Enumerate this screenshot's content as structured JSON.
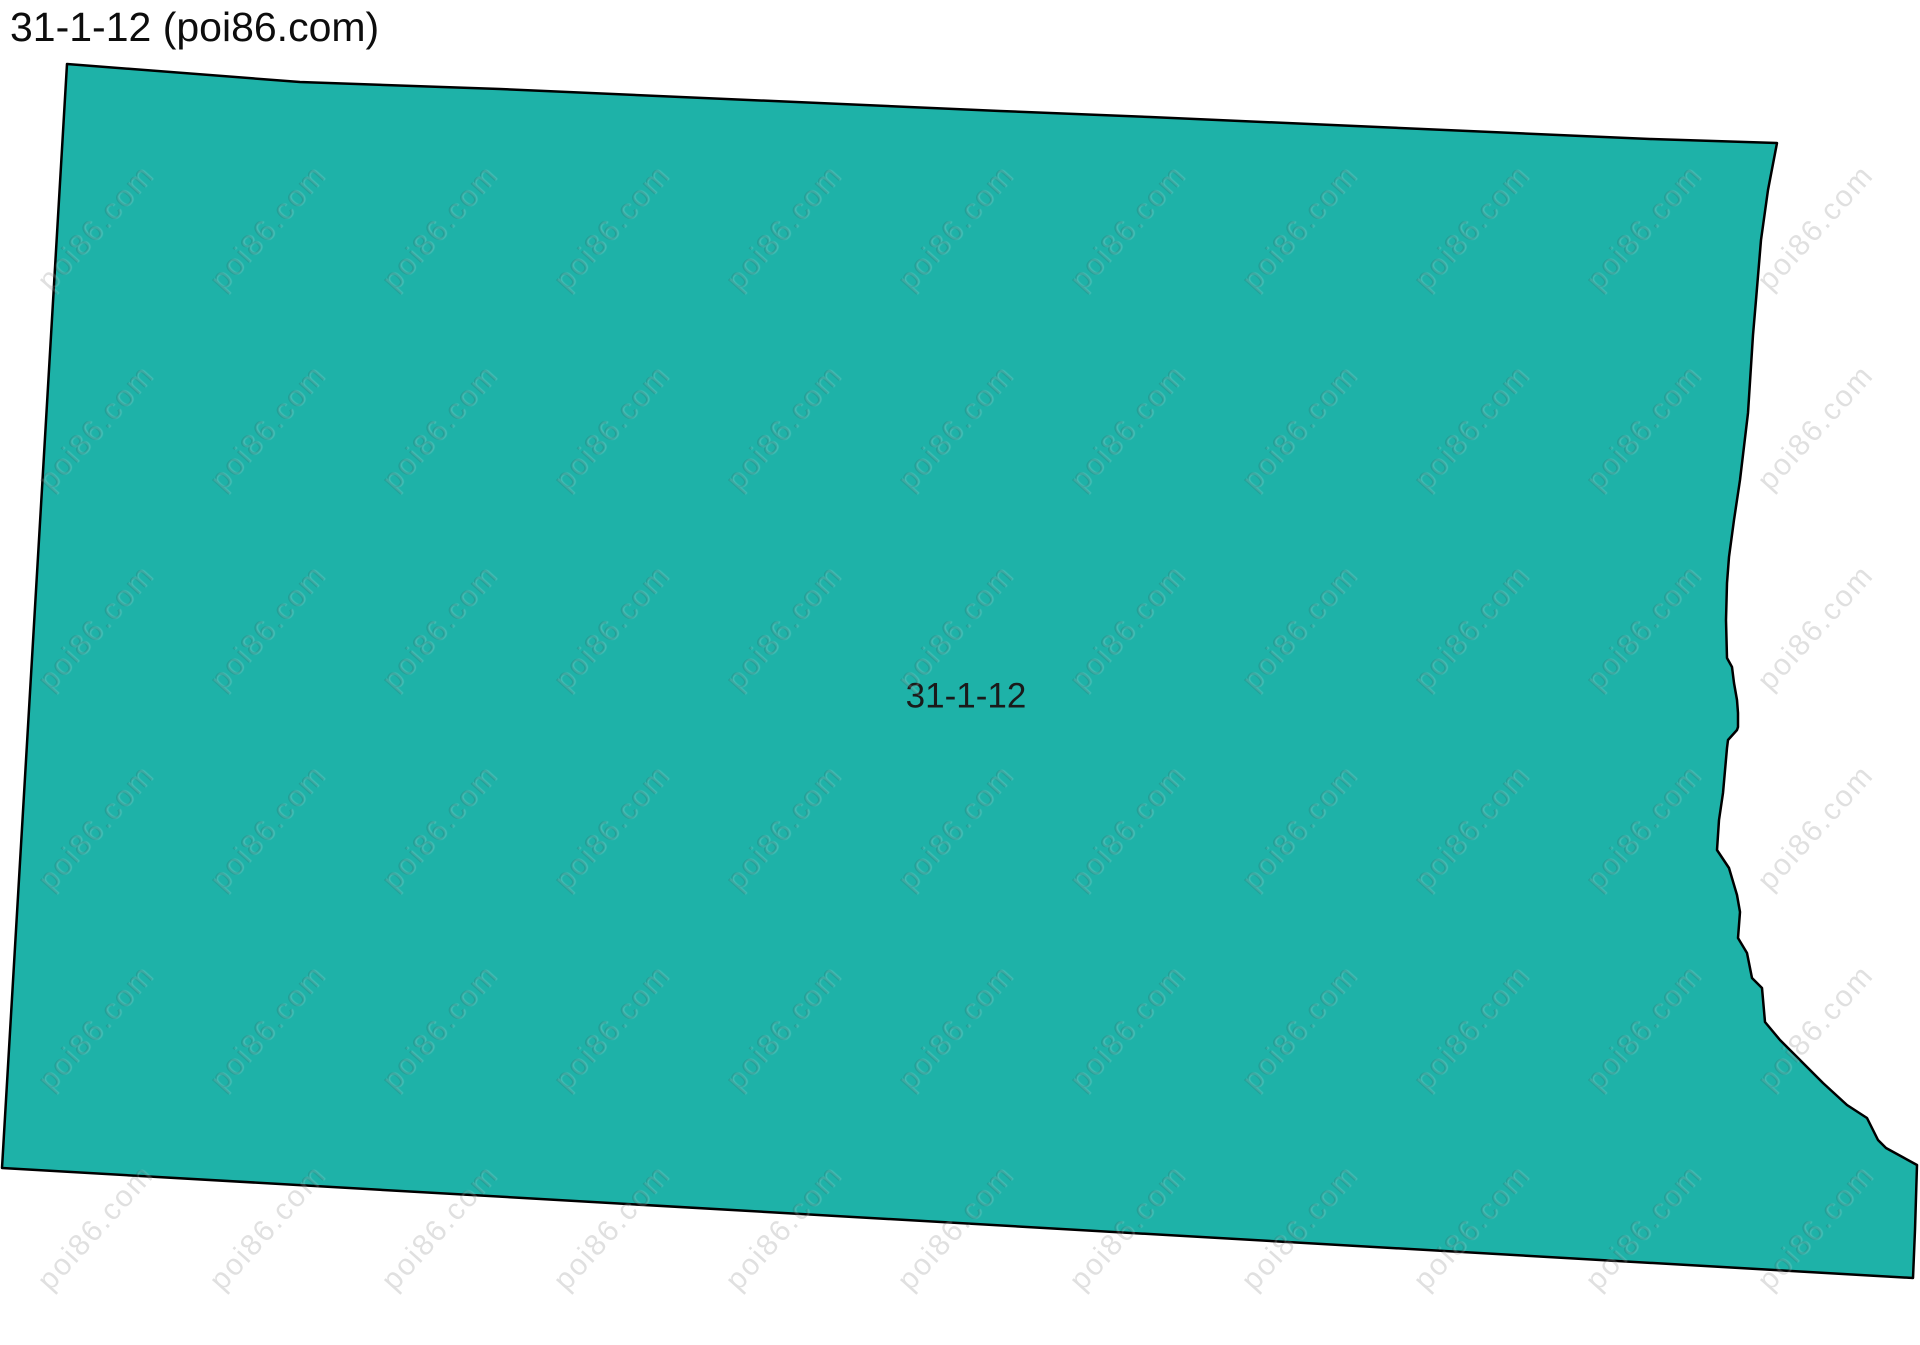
{
  "page": {
    "title": "31-1-12 (poi86.com)",
    "background_color": "#ffffff",
    "title_color": "#0d0d0d"
  },
  "map": {
    "region_label": "31-1-12",
    "label_position": {
      "x": 966,
      "y": 696
    },
    "label_font_size": 35,
    "label_color": "#1a1a1a",
    "fill_color": "#1eb2a8",
    "border_color": "#000000",
    "border_width": 2.5,
    "polygon_points": [
      [
        67,
        64
      ],
      [
        300,
        82
      ],
      [
        500,
        89
      ],
      [
        1000,
        111
      ],
      [
        1150,
        117
      ],
      [
        1650,
        139
      ],
      [
        1777,
        143
      ],
      [
        1768,
        190
      ],
      [
        1761,
        240
      ],
      [
        1756,
        300
      ],
      [
        1753,
        335
      ],
      [
        1748,
        413
      ],
      [
        1740,
        480
      ],
      [
        1734,
        520
      ],
      [
        1729,
        557
      ],
      [
        1727,
        583
      ],
      [
        1726,
        620
      ],
      [
        1727,
        658
      ],
      [
        1732,
        667
      ],
      [
        1734,
        683
      ],
      [
        1737,
        700
      ],
      [
        1738,
        713
      ],
      [
        1738,
        727
      ],
      [
        1737,
        730
      ],
      [
        1728,
        740
      ],
      [
        1727,
        748
      ],
      [
        1723,
        793
      ],
      [
        1719,
        820
      ],
      [
        1717,
        850
      ],
      [
        1729,
        868
      ],
      [
        1737,
        895
      ],
      [
        1740,
        912
      ],
      [
        1738,
        938
      ],
      [
        1747,
        953
      ],
      [
        1752,
        978
      ],
      [
        1762,
        988
      ],
      [
        1765,
        1022
      ],
      [
        1780,
        1040
      ],
      [
        1800,
        1060
      ],
      [
        1823,
        1083
      ],
      [
        1847,
        1105
      ],
      [
        1867,
        1118
      ],
      [
        1878,
        1140
      ],
      [
        1886,
        1148
      ],
      [
        1917,
        1165
      ],
      [
        1915,
        1230
      ],
      [
        1913,
        1278
      ],
      [
        2,
        1168
      ]
    ]
  },
  "watermark": {
    "text": "poi86.com",
    "color": "rgba(45,45,45,0.15)",
    "font_size": 30,
    "letter_spacing": 2,
    "rotation_deg": -48,
    "grid": {
      "origin_x": 96,
      "origin_y": 228,
      "col_spacing": 172,
      "row_spacing": 200,
      "cols": 11,
      "rows": 6
    }
  }
}
